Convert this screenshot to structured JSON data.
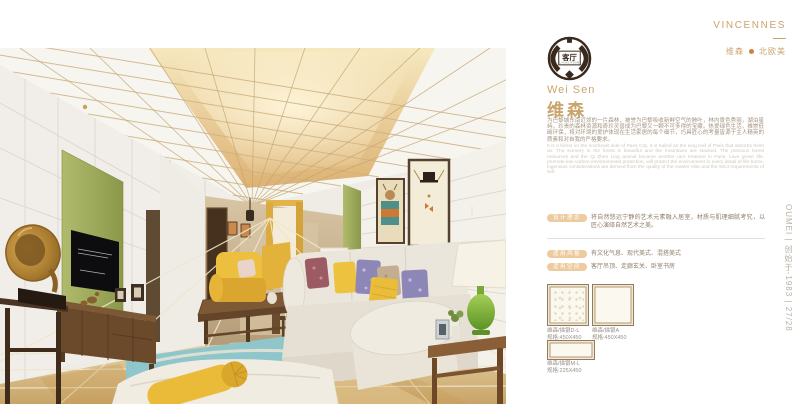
{
  "brand": {
    "name": "VINCENNES",
    "series_cn": "维森",
    "style_cn": "北欧美"
  },
  "logo_badge": {
    "room_cn": "客厅",
    "room_en": "LIVING ROOM"
  },
  "product": {
    "title_en": "Wei Sen",
    "title_cn": "维森",
    "desc_cn": "为巴黎城东南近郊的一片森林，被誉为巴黎吸收新鲜空气的肺叶，林内景色秀丽，湖泊星峙。珍贵的森林资源和奇珍灵兽成为巴黎又一颗不可多得的宝藏。热爱绿色生活，推崇低碳环保，将对环境的爱护体现在生活家居的每个细节，巧具匠心的考量皆源于主人精英的质素和对自我的严格要求。",
    "desc_en": "It is a forest on the southeast side of Paris City. It is hailed as the lung leaf of Paris that absorbs fresh air. The scenery in the forest is beautiful and the mountains are stacked. The precious forest resources and the Qi Zhen Ling animal became another rare treasure in Paris. Love green life, promote low-carbon environmental protection, will protect the environment in every detail of life home, ingenious considerations are derived from the quality of the master elite and the strict requirements of self."
  },
  "info_rows": [
    {
      "label": "设计理念",
      "text": "将自然悠远宁静的艺术元素融入居室，材质与肌理细腻考究，以匠心演绎自然艺术之美。"
    },
    {
      "label": "适用风格",
      "text": "有文化气息、现代美式、混搭美式"
    },
    {
      "label": "适用空间",
      "text": "客厅吊顶、走廊玄关、卧室书房"
    }
  ],
  "swatches": [
    {
      "name": "维森/描银D-L",
      "spec": "规格:450X450"
    },
    {
      "name": "维森/描银A",
      "spec": "规格:450X450"
    },
    {
      "name": "维森/描银M-L",
      "spec": "规格:225X450"
    }
  ],
  "footer": {
    "vertical_text": "OUMEI | 创始于-1983 | 27/28"
  },
  "colors": {
    "accent_gold": "#C9A46B",
    "pill_bg": "#EDCB9F",
    "dot_orange": "#C9823F",
    "ceiling_gold": "#D9B26E",
    "accent_green": "#9FAE58",
    "rug_teal": "#8EC6CB"
  }
}
